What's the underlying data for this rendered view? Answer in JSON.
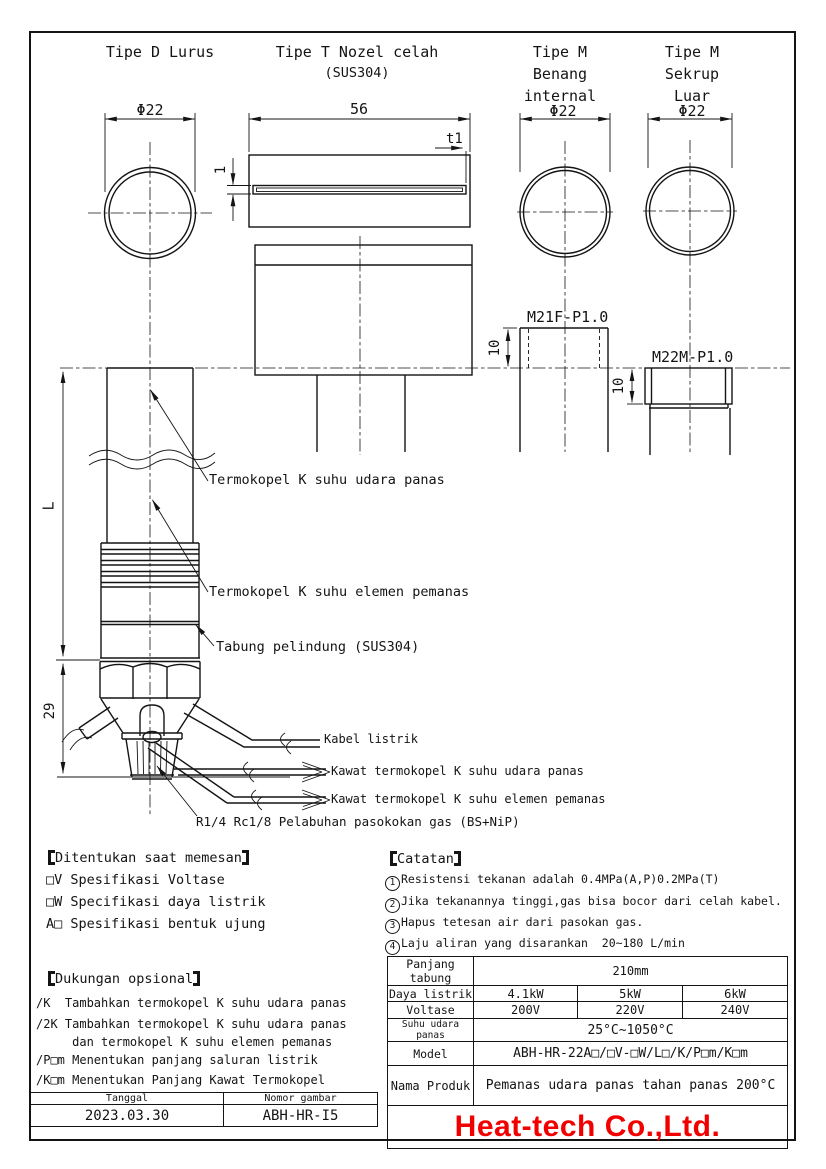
{
  "frame": {
    "company": "Heat-tech Co.,Ltd.",
    "brand_color": "#f20000"
  },
  "views": {
    "tipe_d": {
      "title": "Tipe D Lurus",
      "dia": "Φ22"
    },
    "tipe_t": {
      "title": "Tipe T Nozel celah",
      "material": "(SUS304)",
      "length": "56",
      "slot": "1",
      "wall": "t1"
    },
    "tipe_m_internal": {
      "lines": [
        "Tipe M",
        "Benang",
        "internal"
      ],
      "dia": "Φ22",
      "thread": "M21F-P1.0",
      "depth": "10"
    },
    "tipe_m_luar": {
      "lines": [
        "Tipe M",
        "Sekrup",
        "Luar"
      ],
      "dia": "Φ22",
      "thread": "M22M-P1.0",
      "depth": "10"
    }
  },
  "body": {
    "length": "L",
    "lower": "29",
    "tc_air": "Termokopel K suhu udara panas",
    "tc_heater": "Termokopel K suhu elemen pemanas",
    "tube": "Tabung pelindung (SUS304)",
    "cable": "Kabel listrik",
    "wire_air": "Kawat termokopel K suhu udara panas",
    "wire_heater": "Kawat termokopel K suhu elemen pemanas",
    "gas_port": "R1/4 Rc1/8 Pelabuhan pasokokan gas (BS+NiP)"
  },
  "ordering": {
    "heading": "Ditentukan saat memesan",
    "items": [
      "□V Spesifikasi Voltase",
      "□W Specifikasi daya listrik",
      "A□ Spesifikasi bentuk ujung"
    ]
  },
  "optional": {
    "heading": "Dukungan opsional",
    "items": [
      "/K  Tambahkan termokopel K suhu udara panas",
      "/2K Tambahkan termokopel K suhu udara panas",
      "     dan termokopel K suhu elemen pemanas",
      "/P□m Menentukan panjang saluran listrik",
      "/K□m Menentukan Panjang Kawat Termokopel"
    ]
  },
  "notes": {
    "heading": "Catatan",
    "items": [
      {
        "num": "1",
        "text": "Resistensi tekanan adalah 0.4MPa(A,P)0.2MPa(T)"
      },
      {
        "num": "2",
        "text": "Jika tekanannya tinggi,gas bisa bocor dari celah kabel."
      },
      {
        "num": "3",
        "text": "Hapus tetesan air dari pasokan gas."
      },
      {
        "num": "4",
        "text": "Laju aliran yang disarankan  20~180 L/min"
      }
    ]
  },
  "spec_table": {
    "rows": [
      {
        "label": "Panjang tabung",
        "value": "210mm"
      },
      {
        "label": "Daya listrik",
        "values": [
          "4.1kW",
          "5kW",
          "6kW"
        ]
      },
      {
        "label": "Voltase",
        "values": [
          "200V",
          "220V",
          "240V"
        ]
      },
      {
        "label": "Suhu udara panas",
        "value": "25°C~1050°C"
      },
      {
        "label": "Model",
        "value": "ABH-HR-22A□/□V-□W/L□/K/P□m/K□m"
      },
      {
        "label": "Nama Produk",
        "value": "Pemanas udara panas tahan panas 200°C"
      }
    ]
  },
  "title_block": {
    "date_label": "Tanggal",
    "date": "2023.03.30",
    "number_label": "Nomor gambar",
    "number": "ABH-HR-I5"
  }
}
